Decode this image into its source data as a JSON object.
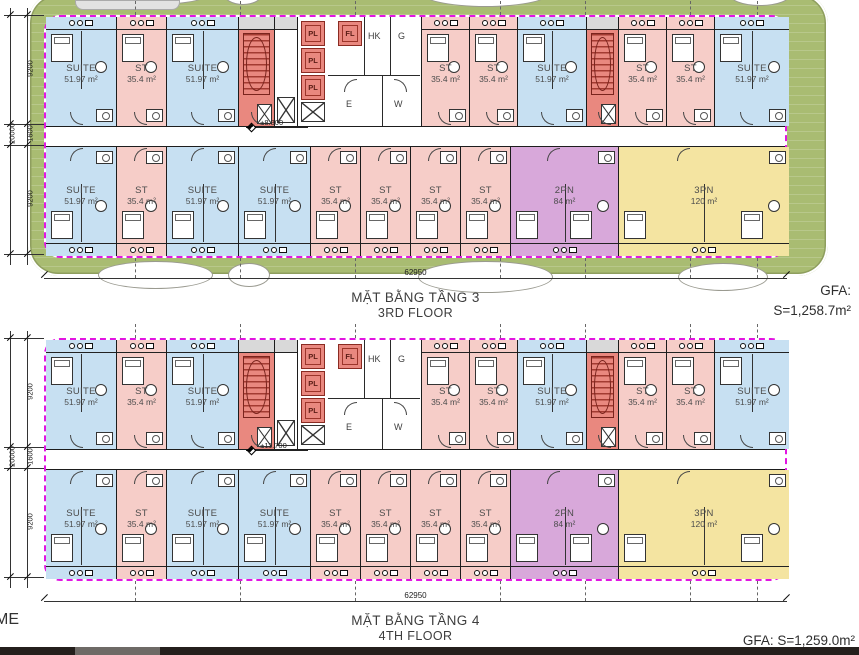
{
  "drawing": {
    "bottom_left_text": "ME"
  },
  "colors": {
    "landscape_green": "#a9bc72",
    "suite_blue": "#c7e0f2",
    "studio_pink": "#f6cdc8",
    "stair_red": "#e9887f",
    "two_bed_purple": "#d8a8da",
    "three_bed_yellow": "#f4e4a1",
    "boundary_magenta": "#e215e2"
  },
  "unit_types": {
    "suite": {
      "name": "SUITE",
      "area": "51.97 m²"
    },
    "st": {
      "name": "ST",
      "area": "35.4 m²"
    },
    "2pn": {
      "name": "2PN",
      "area": "84 m²"
    },
    "3pn": {
      "name": "3PN",
      "area": "120 m²"
    }
  },
  "core": {
    "lifts": [
      "PL",
      "PL",
      "PL"
    ],
    "fire_lift": "FL",
    "rooms": {
      "hk": "HK",
      "g": "G",
      "e": "E",
      "w": "W"
    }
  },
  "rows": {
    "top": [
      {
        "t": "suite",
        "w": 71
      },
      {
        "t": "st",
        "w": 50
      },
      {
        "t": "suite",
        "w": 72
      },
      {
        "t": "stair",
        "w": 36
      },
      {
        "t": "shaft",
        "w": 23
      },
      {
        "t": "core",
        "w": 124
      },
      {
        "t": "st",
        "w": 48
      },
      {
        "t": "st",
        "w": 48
      },
      {
        "t": "suite",
        "w": 69
      },
      {
        "t": "stair",
        "w": 32
      },
      {
        "t": "st",
        "w": 48
      },
      {
        "t": "st",
        "w": 48
      },
      {
        "t": "suite",
        "w": 74
      }
    ],
    "bottom": [
      {
        "t": "suite",
        "w": 71
      },
      {
        "t": "st",
        "w": 50
      },
      {
        "t": "suite",
        "w": 72
      },
      {
        "t": "suite",
        "w": 72
      },
      {
        "t": "st",
        "w": 50
      },
      {
        "t": "st",
        "w": 50
      },
      {
        "t": "st",
        "w": 50
      },
      {
        "t": "st",
        "w": 50
      },
      {
        "t": "2pn",
        "w": 108
      },
      {
        "t": "3pn",
        "w": 170
      }
    ]
  },
  "floors": [
    {
      "title_vi": "MẶT BẰNG TẦNG 3",
      "title_en": "3RD FLOOR",
      "gfa_line1": "GFA:",
      "gfa_line2": "S=1,258.7m²",
      "elevation": "+8.300",
      "bottom_dim": "62950",
      "side_dims": [
        "9200",
        "1600",
        "9200"
      ],
      "side_total": "20000"
    },
    {
      "title_vi": "MẶT BẰNG TẦNG 4",
      "title_en": "4TH FLOOR",
      "gfa_line1": "GFA: S=1,259.0m²",
      "gfa_line2": "",
      "elevation": "+11.700",
      "bottom_dim": "62950",
      "side_dims": [
        "9200",
        "1600",
        "9200"
      ],
      "side_total": "20000"
    }
  ]
}
